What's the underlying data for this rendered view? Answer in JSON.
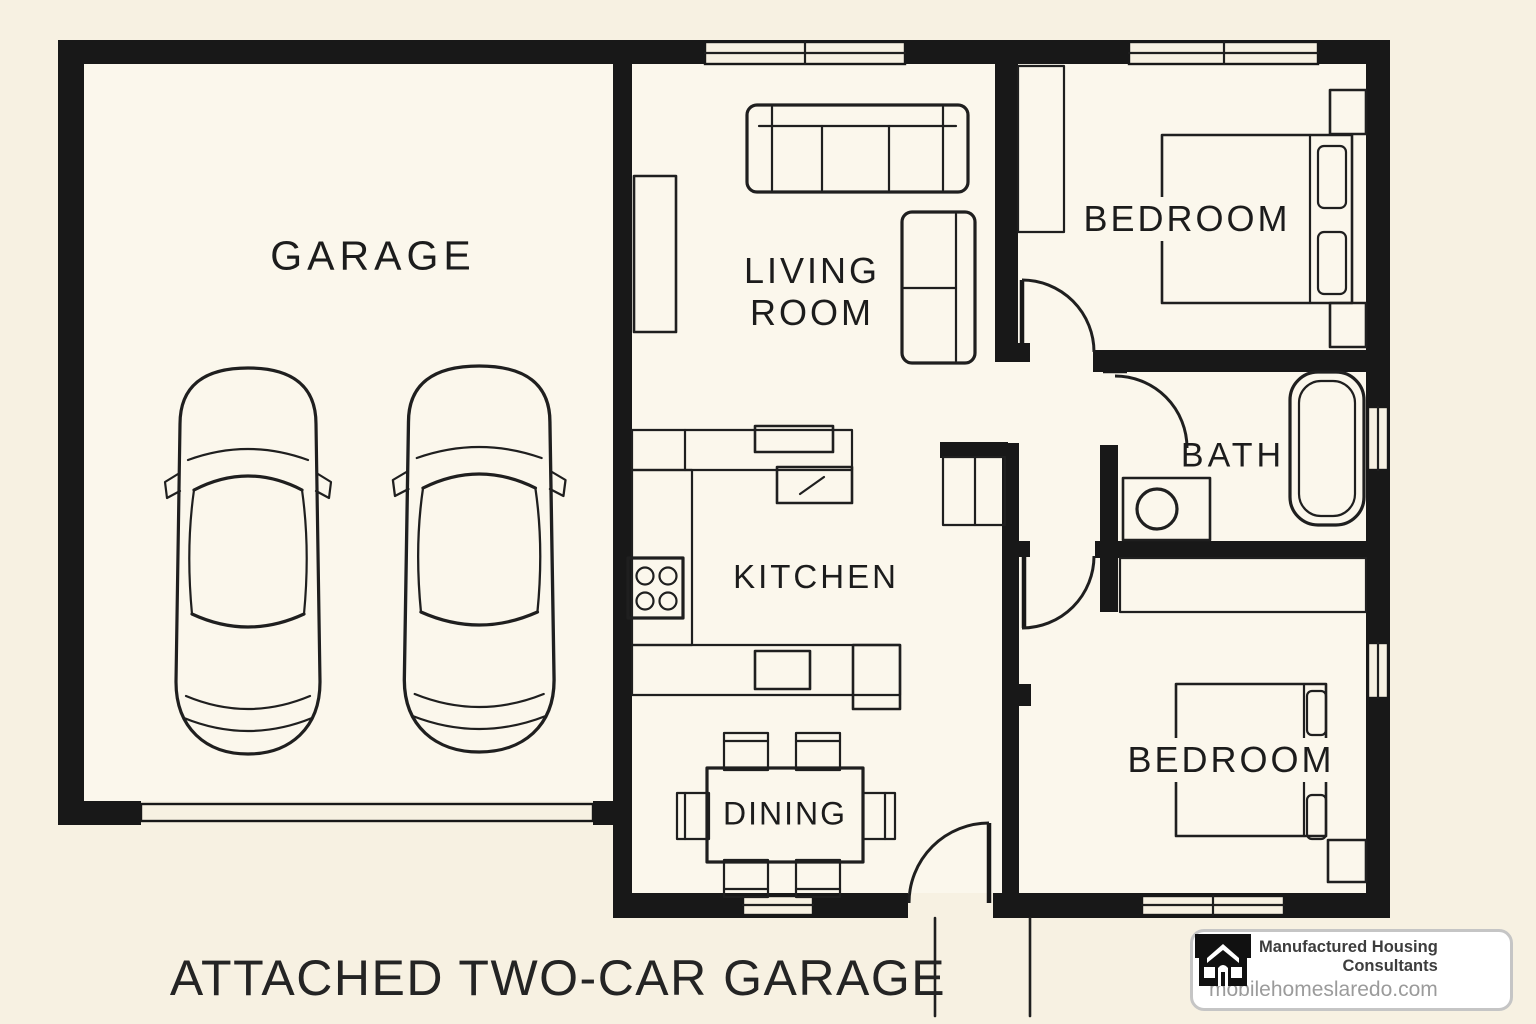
{
  "floor_plan": {
    "caption": "ATTACHED TWO-CAR GARAGE",
    "rooms": {
      "garage": {
        "label": "GARAGE"
      },
      "living_room": {
        "line1": "LIVING",
        "line2": "ROOM"
      },
      "bedroom_top": {
        "label": "BEDROOM"
      },
      "bath": {
        "label": "BATH"
      },
      "kitchen": {
        "label": "KITCHEN"
      },
      "dining": {
        "label": "DINING"
      },
      "bedroom_bottom": {
        "label": "BEDROOM"
      }
    }
  },
  "watermark": {
    "company": "Manufactured Housing Consultants",
    "website": "mobilehomeslaredo.com",
    "icon": "house-icon"
  },
  "colors": {
    "background": "#f7f1e2",
    "floor": "#fbf7ec",
    "wall": "#181818",
    "line": "#1f1f1f",
    "text": "#1c1c1c",
    "badge_border": "#c5c5c5",
    "badge_company": "#3d3d3d",
    "badge_website": "#9b9b9b"
  }
}
